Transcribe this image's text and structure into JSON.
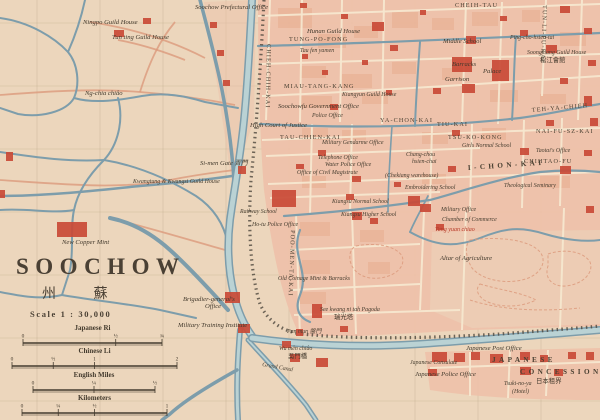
{
  "colors": {
    "paper": "#ecd6bc",
    "city_block": "#eec0a8",
    "block_shade": "#e5a98c",
    "building_red": "#c94a36",
    "water_stroke": "#7d9dab",
    "water_fill": "#bad2d4",
    "street_cream": "#f5e7cf",
    "wall_dark": "#4c463c",
    "road_pink": "#dc9a7c",
    "text_dark": "#42392c",
    "text_red": "#b43a28",
    "grid": "#a79572"
  },
  "title_block": {
    "title": "SOOCHOW",
    "title_chinese": "州 蘇",
    "scale_text": "Scale  1 : 30,000"
  },
  "scale_bars": [
    {
      "label": "Japanese Ri",
      "x1": 23,
      "x2": 162,
      "ly": 330,
      "ticks": [
        {
          "v": "0",
          "p": 0
        },
        {
          "v": "½",
          "p": 0.667
        },
        {
          "v": "¾",
          "p": 1
        }
      ]
    },
    {
      "label": "Chinese Li",
      "x1": 12,
      "x2": 177,
      "ly": 353,
      "ticks": [
        {
          "v": "0",
          "p": 0
        },
        {
          "v": "½",
          "p": 0.25
        },
        {
          "v": "1",
          "p": 0.5
        },
        {
          "v": "2",
          "p": 1
        }
      ]
    },
    {
      "label": "English Miles",
      "x1": 33,
      "x2": 155,
      "ly": 377,
      "ticks": [
        {
          "v": "0",
          "p": 0
        },
        {
          "v": "¼",
          "p": 0.5
        },
        {
          "v": "½",
          "p": 1
        }
      ]
    },
    {
      "label": "Kilometers",
      "x1": 22,
      "x2": 167,
      "ly": 400,
      "ticks": [
        {
          "v": "0",
          "p": 0
        },
        {
          "v": "¼",
          "p": 0.25
        },
        {
          "v": "½",
          "p": 0.5
        },
        {
          "v": "1",
          "p": 1
        }
      ]
    }
  ],
  "labels": [
    {
      "t": "Ningpo Guild House",
      "x": 83,
      "y": 24,
      "c": "lbl"
    },
    {
      "t": "Tun ting Guild House",
      "x": 112,
      "y": 39,
      "c": "lbl"
    },
    {
      "t": "Ng-chia chiâo",
      "x": 85,
      "y": 95,
      "c": "lbl"
    },
    {
      "t": "Soochow Prefectural Office",
      "x": 195,
      "y": 9,
      "c": "lbl"
    },
    {
      "t": "Hunan Guild House",
      "x": 307,
      "y": 33,
      "c": "lbl"
    },
    {
      "t": "TUNG-PO-FONG",
      "x": 289,
      "y": 41,
      "c": "street"
    },
    {
      "t": "Tau fen yamen",
      "x": 300,
      "y": 52,
      "c": "lbl-sm"
    },
    {
      "t": "MIAU-TANG-KANG",
      "x": 284,
      "y": 88,
      "c": "street"
    },
    {
      "t": "Kiangyun Guild House",
      "x": 342,
      "y": 96,
      "c": "lbl-sm"
    },
    {
      "t": "Soochowfu Government Office",
      "x": 278,
      "y": 108,
      "c": "lbl"
    },
    {
      "t": "CHEIH-TAU",
      "x": 455,
      "y": 7,
      "c": "street"
    },
    {
      "t": "TUN-LI-PU-KAI",
      "x": 543,
      "y": 5,
      "c": "street",
      "r": 92
    },
    {
      "t": "CHIEH-CHIH-KAI",
      "x": 267,
      "y": 44,
      "c": "street",
      "r": 91
    },
    {
      "t": "Middle School",
      "x": 443,
      "y": 43,
      "c": "lbl"
    },
    {
      "t": "Ping-cho-hsien-tai",
      "x": 510,
      "y": 39,
      "c": "lbl-sm"
    },
    {
      "t": "Barracks",
      "x": 452,
      "y": 66,
      "c": "lbl"
    },
    {
      "t": "Palace",
      "x": 483,
      "y": 73,
      "c": "lbl"
    },
    {
      "t": "Garrison",
      "x": 445,
      "y": 81,
      "c": "lbl"
    },
    {
      "t": "Soongkiang Guild House",
      "x": 527,
      "y": 54,
      "c": "lbl-sm"
    },
    {
      "t": "松江會館",
      "x": 540,
      "y": 62,
      "c": "cn"
    },
    {
      "t": "Police Office",
      "x": 312,
      "y": 117,
      "c": "lbl-sm"
    },
    {
      "t": "High Court of Justice",
      "x": 250,
      "y": 127,
      "c": "lbl"
    },
    {
      "t": "TAU-CHIEN-KAI",
      "x": 280,
      "y": 139,
      "c": "street"
    },
    {
      "t": "YA-CHON-KAI",
      "x": 380,
      "y": 122,
      "c": "street"
    },
    {
      "t": "TIU-KAI",
      "x": 437,
      "y": 126,
      "c": "street"
    },
    {
      "t": "TEH-YA-CHIEH",
      "x": 532,
      "y": 112,
      "c": "street",
      "r": -5
    },
    {
      "t": "NAI-FU-SZ-KAI",
      "x": 536,
      "y": 133,
      "c": "street"
    },
    {
      "t": "Military Gendarme Office",
      "x": 322,
      "y": 144,
      "c": "lbl-sm"
    },
    {
      "t": "Chang-chou",
      "x": 406,
      "y": 156,
      "c": "lbl-sm"
    },
    {
      "t": "hsien-chai",
      "x": 412,
      "y": 163,
      "c": "lbl-sm"
    },
    {
      "t": "Telephone Office",
      "x": 318,
      "y": 159,
      "c": "lbl-sm"
    },
    {
      "t": "Water Police Office",
      "x": 325,
      "y": 166,
      "c": "lbl-sm"
    },
    {
      "t": "Office of Civil Magistrate",
      "x": 297,
      "y": 174,
      "c": "lbl-sm"
    },
    {
      "t": "(Chekiang warehouse)",
      "x": 385,
      "y": 177,
      "c": "lbl-sm"
    },
    {
      "t": "TSU-KO-KONG",
      "x": 448,
      "y": 139,
      "c": "street"
    },
    {
      "t": "Girls Normal School",
      "x": 462,
      "y": 147,
      "c": "lbl-sm"
    },
    {
      "t": "Taotai's Office",
      "x": 536,
      "y": 152,
      "c": "lbl-sm"
    },
    {
      "t": "CHIHTAO-FU",
      "x": 524,
      "y": 163,
      "c": "street"
    },
    {
      "t": "I-CHON-KAI",
      "x": 468,
      "y": 170,
      "c": "street-big",
      "r": -4
    },
    {
      "t": "Theological Seminary",
      "x": 504,
      "y": 187,
      "c": "lbl-sm"
    },
    {
      "t": "Embroidering School",
      "x": 405,
      "y": 189,
      "c": "lbl-sm"
    },
    {
      "t": "Si-men Gate 胥門",
      "x": 200,
      "y": 165,
      "c": "lbl"
    },
    {
      "t": "Kwangtung & Kwangsi Guild House",
      "x": 133,
      "y": 183,
      "c": "lbl-sm"
    },
    {
      "t": "Kiangsu Normal School",
      "x": 332,
      "y": 203,
      "c": "lbl-sm"
    },
    {
      "t": "Kiangsu Higher School",
      "x": 341,
      "y": 216,
      "c": "lbl-sm"
    },
    {
      "t": "Military Office",
      "x": 441,
      "y": 211,
      "c": "lbl-sm"
    },
    {
      "t": "Chamber of Commerce",
      "x": 442,
      "y": 221,
      "c": "lbl-sm"
    },
    {
      "t": "Tang yuan chiao",
      "x": 435,
      "y": 231,
      "c": "red"
    },
    {
      "t": "Altar of Agriculture",
      "x": 440,
      "y": 260,
      "c": "lbl"
    },
    {
      "t": "Railway School",
      "x": 240,
      "y": 213,
      "c": "lbl-sm"
    },
    {
      "t": "Ho-tu Police Office",
      "x": 252,
      "y": 226,
      "c": "lbl-sm"
    },
    {
      "t": "Old Coinage Mint & Barracks",
      "x": 278,
      "y": 280,
      "c": "lbl-sm"
    },
    {
      "t": "POO-MEN-TA-KAI",
      "x": 291,
      "y": 230,
      "c": "street",
      "r": 92
    },
    {
      "t": "New Copper Mint",
      "x": 62,
      "y": 244,
      "c": "lbl"
    },
    {
      "t": "Brigadier-general's",
      "x": 183,
      "y": 301,
      "c": "lbl"
    },
    {
      "t": "Office",
      "x": 205,
      "y": 308,
      "c": "lbl"
    },
    {
      "t": "Military Training Institute",
      "x": 178,
      "y": 327,
      "c": "lbl"
    },
    {
      "t": "See kwang ni tah Pagoda",
      "x": 320,
      "y": 311,
      "c": "lbl-sm"
    },
    {
      "t": "瑞光塔",
      "x": 334,
      "y": 319,
      "c": "cn"
    },
    {
      "t": "Pan mun 盤門",
      "x": 287,
      "y": 333,
      "c": "lbl-sm"
    },
    {
      "t": "Wu mên chiâo",
      "x": 279,
      "y": 350,
      "c": "lbl-sm"
    },
    {
      "t": "吳門橋",
      "x": 288,
      "y": 358,
      "c": "cn"
    },
    {
      "t": "Grand Canal",
      "x": 262,
      "y": 366,
      "c": "lbl-sm",
      "r": 10
    },
    {
      "t": "Japanese Post Office",
      "x": 466,
      "y": 350,
      "c": "lbl"
    },
    {
      "t": "JAPANESE",
      "x": 492,
      "y": 362,
      "c": "street-big"
    },
    {
      "t": "CONCESSION",
      "x": 520,
      "y": 374,
      "c": "street-big"
    },
    {
      "t": "日本租界",
      "x": 536,
      "y": 383,
      "c": "cn"
    },
    {
      "t": "Japanese Consulate",
      "x": 410,
      "y": 364,
      "c": "lbl-sm"
    },
    {
      "t": "Japanese Police Office",
      "x": 415,
      "y": 376,
      "c": "lbl"
    },
    {
      "t": "Tsuki-no-ya",
      "x": 504,
      "y": 385,
      "c": "lbl-sm"
    },
    {
      "t": "(Hotel)",
      "x": 512,
      "y": 393,
      "c": "lbl-sm"
    }
  ]
}
